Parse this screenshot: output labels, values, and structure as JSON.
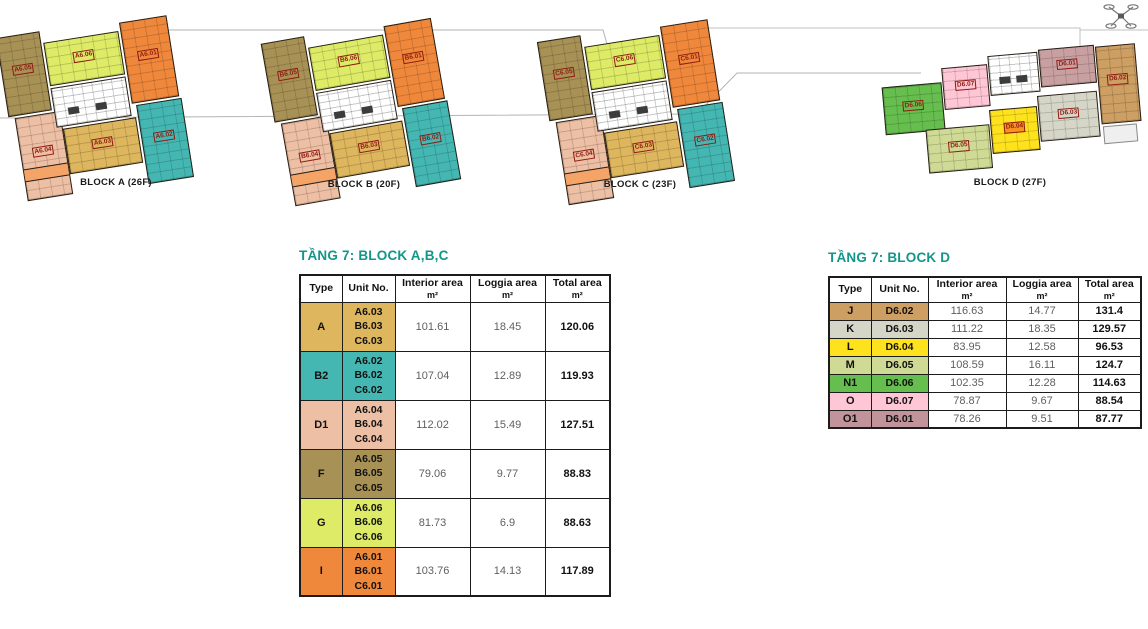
{
  "plans": {
    "accent_orange": "#F5A468",
    "blocks": [
      {
        "caption": "BLOCK A (26F)",
        "units": [
          {
            "label": "A6.05",
            "color": "#A89155"
          },
          {
            "label": "A6.06",
            "color": "#DDEB67"
          },
          {
            "label": "A6.01",
            "color": "#F0883C"
          },
          {
            "label": "A6.04",
            "color": "#EDBFA4"
          },
          {
            "label": "A6.03",
            "color": "#DDB65E"
          },
          {
            "label": "A6.02",
            "color": "#45B7B3"
          }
        ]
      },
      {
        "caption": "BLOCK B (20F)",
        "units": [
          {
            "label": "B6.05",
            "color": "#A89155"
          },
          {
            "label": "B6.06",
            "color": "#DDEB67"
          },
          {
            "label": "B6.01",
            "color": "#F0883C"
          },
          {
            "label": "B6.04",
            "color": "#EDBFA4"
          },
          {
            "label": "B6.03",
            "color": "#DDB65E"
          },
          {
            "label": "B6.02",
            "color": "#45B7B3"
          }
        ]
      },
      {
        "caption": "BLOCK C (23F)",
        "units": [
          {
            "label": "C6.05",
            "color": "#A89155"
          },
          {
            "label": "C6.06",
            "color": "#DDEB67"
          },
          {
            "label": "C6.01",
            "color": "#F0883C"
          },
          {
            "label": "C6.04",
            "color": "#EDBFA4"
          },
          {
            "label": "C6.03",
            "color": "#DDB65E"
          },
          {
            "label": "C6.02",
            "color": "#45B7B3"
          }
        ]
      },
      {
        "caption": "BLOCK D (27F)",
        "units": [
          {
            "label": "D6.06",
            "color": "#66BE4E"
          },
          {
            "label": "D6.07",
            "color": "#FFC6D5"
          },
          {
            "label": "D6.01",
            "color": "#C9A0A2"
          },
          {
            "label": "D6.02",
            "color": "#CD9F63"
          },
          {
            "label": "D6.05",
            "color": "#CFDA94"
          },
          {
            "label": "D6.04",
            "color": "#FFE21E",
            "label_bg": "#F7941D"
          },
          {
            "label": "D6.03",
            "color": "#D6D6C8"
          }
        ]
      }
    ]
  },
  "tables": [
    {
      "title": "TẦNG 7: BLOCK A,B,C",
      "columns": [
        {
          "label": "Type",
          "unit": ""
        },
        {
          "label": "Unit No.",
          "unit": ""
        },
        {
          "label": "Interior area",
          "unit": "m²"
        },
        {
          "label": "Loggia area",
          "unit": "m²"
        },
        {
          "label": "Total area",
          "unit": "m²"
        }
      ],
      "rows": [
        {
          "type": "A",
          "color": "#DDB65E",
          "units": [
            "A6.03",
            "B6.03",
            "C6.03"
          ],
          "interior": "101.61",
          "loggia": "18.45",
          "total": "120.06"
        },
        {
          "type": "B2",
          "color": "#45B7B3",
          "units": [
            "A6.02",
            "B6.02",
            "C6.02"
          ],
          "interior": "107.04",
          "loggia": "12.89",
          "total": "119.93"
        },
        {
          "type": "D1",
          "color": "#EDBFA4",
          "units": [
            "A6.04",
            "B6.04",
            "C6.04"
          ],
          "interior": "112.02",
          "loggia": "15.49",
          "total": "127.51"
        },
        {
          "type": "F",
          "color": "#A89155",
          "units": [
            "A6.05",
            "B6.05",
            "C6.05"
          ],
          "interior": "79.06",
          "loggia": "9.77",
          "total": "88.83"
        },
        {
          "type": "G",
          "color": "#DDEB67",
          "units": [
            "A6.06",
            "B6.06",
            "C6.06"
          ],
          "interior": "81.73",
          "loggia": "6.9",
          "total": "88.63"
        },
        {
          "type": "I",
          "color": "#F0883C",
          "units": [
            "A6.01",
            "B6.01",
            "C6.01"
          ],
          "interior": "103.76",
          "loggia": "14.13",
          "total": "117.89"
        }
      ]
    },
    {
      "title": "TẦNG 7: BLOCK D",
      "columns": [
        {
          "label": "Type",
          "unit": ""
        },
        {
          "label": "Unit No.",
          "unit": ""
        },
        {
          "label": "Interior area",
          "unit": "m²"
        },
        {
          "label": "Loggia area",
          "unit": "m²"
        },
        {
          "label": "Total area",
          "unit": "m²"
        }
      ],
      "rows": [
        {
          "type": "J",
          "color": "#CD9F63",
          "unit": "D6.02",
          "interior": "116.63",
          "loggia": "14.77",
          "total": "131.4"
        },
        {
          "type": "K",
          "color": "#D6D6C8",
          "unit": "D6.03",
          "interior": "111.22",
          "loggia": "18.35",
          "total": "129.57"
        },
        {
          "type": "L",
          "color": "#FFE21E",
          "unit": "D6.04",
          "interior": "83.95",
          "loggia": "12.58",
          "total": "96.53"
        },
        {
          "type": "M",
          "color": "#CFDA94",
          "unit": "D6.05",
          "interior": "108.59",
          "loggia": "16.11",
          "total": "124.7"
        },
        {
          "type": "N1",
          "color": "#66BE4E",
          "unit": "D6.06",
          "interior": "102.35",
          "loggia": "12.28",
          "total": "114.63"
        },
        {
          "type": "O",
          "color": "#FFC6D5",
          "unit": "D6.07",
          "interior": "78.87",
          "loggia": "9.67",
          "total": "88.54"
        },
        {
          "type": "O1",
          "color": "#C1939B",
          "unit": "D6.01",
          "interior": "78.26",
          "loggia": "9.51",
          "total": "87.77"
        }
      ]
    }
  ]
}
